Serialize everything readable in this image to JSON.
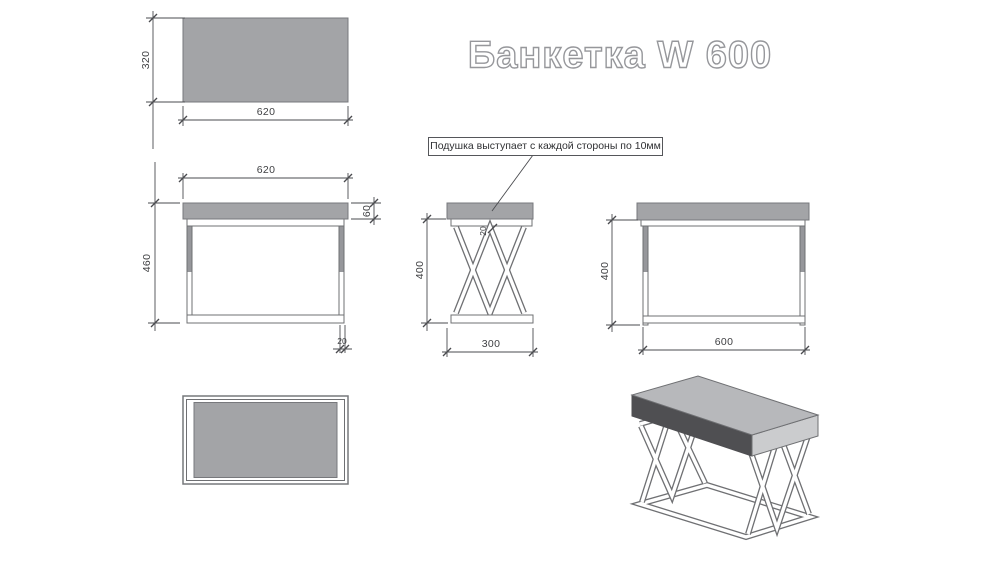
{
  "title": "Банкетка W 600",
  "callout": "Подушка выступает с каждой стороны по 10мм",
  "views": {
    "top_view": {
      "label_depth": "320",
      "label_width": "620"
    },
    "front_view": {
      "label_width": "620",
      "label_height": "460",
      "label_cushion": "60",
      "label_leg": "20"
    },
    "side_view": {
      "label_height": "400",
      "label_width": "300",
      "label_tube": "20"
    },
    "end_view": {
      "label_height": "400",
      "label_width": "600"
    }
  },
  "colors": {
    "cushion-gray": "#a3a4a7",
    "leg-gray": "#96979b",
    "outline": "#77787c",
    "frame-line": "#6f7073",
    "dim-line": "#4a4b4f",
    "dim-text": "#3f4043",
    "title-outline": "#96979b",
    "iso-top": "#b7b8bb",
    "iso-front": "#4f4f52",
    "iso-side": "#cbccce"
  }
}
